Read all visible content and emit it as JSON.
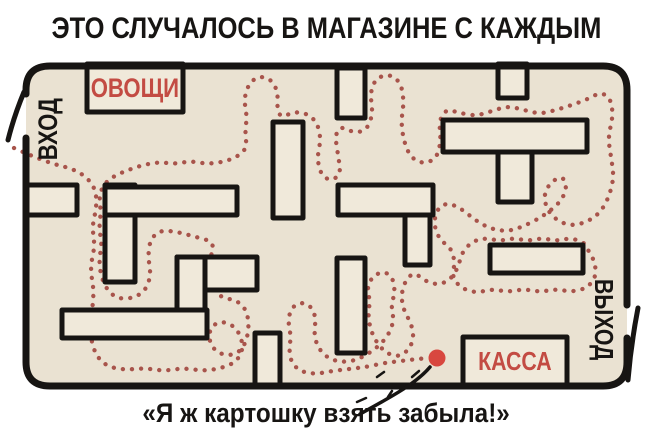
{
  "title": "ЭТО СЛУЧАЛОСЬ В МАГАЗИНЕ С КАЖДЫМ",
  "caption": "«Я ж картошку взять забыла!»",
  "labels": {
    "entrance": "ВХОД",
    "exit": "ВЫХОД",
    "vegetables": "ОВОЩИ",
    "checkout": "КАССА"
  },
  "colors": {
    "background": "#ffffff",
    "floor": "#eae2d2",
    "shelf_fill": "#f0e9da",
    "wall_black": "#171513",
    "path_dots": "#a8544b",
    "label_red": "#c34b43",
    "end_dot_red": "#d8473f"
  },
  "maze": {
    "floor_rect": [
      26,
      66,
      601,
      320
    ],
    "shelves": [
      [
        87,
        64,
        96,
        48
      ],
      [
        27,
        185,
        50,
        30
      ],
      [
        105,
        185,
        30,
        97
      ],
      [
        105,
        187,
        132,
        28
      ],
      [
        273,
        122,
        30,
        96
      ],
      [
        337,
        68,
        28,
        50
      ],
      [
        498,
        64,
        29,
        34
      ],
      [
        443,
        120,
        144,
        32
      ],
      [
        498,
        152,
        34,
        50
      ],
      [
        338,
        185,
        95,
        30
      ],
      [
        405,
        215,
        25,
        50
      ],
      [
        177,
        257,
        80,
        33
      ],
      [
        177,
        257,
        28,
        53
      ],
      [
        62,
        310,
        145,
        28
      ],
      [
        255,
        333,
        25,
        52
      ],
      [
        337,
        258,
        28,
        95
      ],
      [
        490,
        245,
        93,
        28
      ],
      [
        463,
        337,
        104,
        48
      ]
    ],
    "doors": [
      [
        24,
        92,
        8,
        140
      ],
      [
        638,
        308,
        628,
        380
      ]
    ],
    "end_dot": {
      "x": 437,
      "y": 358,
      "r": 8.5
    },
    "annotation": {
      "line": [
        360,
        414,
        385,
        400,
        415,
        385,
        430,
        367
      ],
      "ticks": [
        [
          384,
          372,
          377,
          377
        ],
        [
          366,
          398,
          357,
          402
        ],
        [
          412,
          377,
          419,
          371
        ],
        [
          392,
          391,
          388,
          397
        ]
      ]
    },
    "path": [
      [
        14,
        148
      ],
      [
        45,
        162
      ],
      [
        78,
        170
      ],
      [
        95,
        186
      ],
      [
        97,
        206
      ],
      [
        92,
        226
      ],
      [
        95,
        246
      ],
      [
        90,
        268
      ],
      [
        94,
        290
      ],
      [
        92,
        312
      ],
      [
        90,
        334
      ],
      [
        95,
        354
      ],
      [
        106,
        366
      ],
      [
        124,
        370
      ],
      [
        144,
        368
      ],
      [
        164,
        371
      ],
      [
        184,
        368
      ],
      [
        204,
        371
      ],
      [
        222,
        368
      ],
      [
        236,
        362
      ],
      [
        243,
        350
      ],
      [
        241,
        336
      ],
      [
        233,
        325
      ],
      [
        220,
        321
      ],
      [
        210,
        328
      ],
      [
        209,
        341
      ],
      [
        216,
        352
      ],
      [
        229,
        356
      ],
      [
        241,
        351
      ],
      [
        247,
        339
      ],
      [
        249,
        324
      ],
      [
        246,
        309
      ],
      [
        236,
        300
      ],
      [
        222,
        298
      ],
      [
        212,
        288
      ],
      [
        209,
        272
      ],
      [
        211,
        256
      ],
      [
        214,
        242
      ],
      [
        196,
        237
      ],
      [
        178,
        232
      ],
      [
        160,
        230
      ],
      [
        150,
        240
      ],
      [
        148,
        257
      ],
      [
        151,
        274
      ],
      [
        146,
        290
      ],
      [
        134,
        298
      ],
      [
        118,
        299
      ],
      [
        107,
        290
      ],
      [
        101,
        276
      ],
      [
        99,
        260
      ],
      [
        102,
        244
      ],
      [
        99,
        228
      ],
      [
        101,
        212
      ],
      [
        99,
        196
      ],
      [
        104,
        184
      ],
      [
        114,
        176
      ],
      [
        128,
        170
      ],
      [
        143,
        165
      ],
      [
        159,
        162
      ],
      [
        175,
        164
      ],
      [
        191,
        161
      ],
      [
        207,
        164
      ],
      [
        223,
        162
      ],
      [
        237,
        157
      ],
      [
        247,
        148
      ],
      [
        245,
        133
      ],
      [
        247,
        116
      ],
      [
        244,
        100
      ],
      [
        248,
        85
      ],
      [
        258,
        76
      ],
      [
        271,
        79
      ],
      [
        278,
        92
      ],
      [
        277,
        108
      ],
      [
        281,
        118
      ],
      [
        293,
        112
      ],
      [
        306,
        113
      ],
      [
        317,
        122
      ],
      [
        321,
        139
      ],
      [
        317,
        158
      ],
      [
        321,
        175
      ],
      [
        331,
        181
      ],
      [
        341,
        174
      ],
      [
        338,
        155
      ],
      [
        335,
        135
      ],
      [
        341,
        126
      ],
      [
        354,
        133
      ],
      [
        367,
        130
      ],
      [
        373,
        113
      ],
      [
        370,
        93
      ],
      [
        376,
        78
      ],
      [
        390,
        74
      ],
      [
        401,
        83
      ],
      [
        404,
        102
      ],
      [
        401,
        122
      ],
      [
        404,
        142
      ],
      [
        411,
        158
      ],
      [
        424,
        164
      ],
      [
        437,
        158
      ],
      [
        441,
        140
      ],
      [
        439,
        121
      ],
      [
        446,
        109
      ],
      [
        460,
        113
      ],
      [
        476,
        116
      ],
      [
        492,
        111
      ],
      [
        508,
        106
      ],
      [
        524,
        110
      ],
      [
        540,
        114
      ],
      [
        556,
        110
      ],
      [
        572,
        105
      ],
      [
        588,
        99
      ],
      [
        601,
        92
      ],
      [
        611,
        99
      ],
      [
        613,
        117
      ],
      [
        608,
        137
      ],
      [
        611,
        157
      ],
      [
        614,
        177
      ],
      [
        609,
        197
      ],
      [
        600,
        213
      ],
      [
        587,
        222
      ],
      [
        571,
        226
      ],
      [
        556,
        220
      ],
      [
        546,
        208
      ],
      [
        544,
        193
      ],
      [
        552,
        181
      ],
      [
        563,
        176
      ],
      [
        567,
        188
      ],
      [
        561,
        201
      ],
      [
        550,
        211
      ],
      [
        538,
        219
      ],
      [
        524,
        226
      ],
      [
        510,
        231
      ],
      [
        495,
        230
      ],
      [
        481,
        224
      ],
      [
        469,
        215
      ],
      [
        457,
        206
      ],
      [
        445,
        203
      ],
      [
        436,
        211
      ],
      [
        434,
        226
      ],
      [
        440,
        240
      ],
      [
        451,
        248
      ],
      [
        455,
        262
      ],
      [
        452,
        277
      ],
      [
        461,
        288
      ],
      [
        476,
        293
      ],
      [
        492,
        289
      ],
      [
        508,
        292
      ],
      [
        524,
        289
      ],
      [
        540,
        292
      ],
      [
        556,
        289
      ],
      [
        572,
        292
      ],
      [
        587,
        288
      ],
      [
        596,
        277
      ],
      [
        595,
        262
      ],
      [
        588,
        250
      ],
      [
        584,
        242
      ],
      [
        570,
        238
      ],
      [
        556,
        241
      ],
      [
        542,
        238
      ],
      [
        528,
        241
      ],
      [
        514,
        238
      ],
      [
        500,
        241
      ],
      [
        486,
        238
      ],
      [
        473,
        241
      ],
      [
        462,
        252
      ],
      [
        458,
        268
      ],
      [
        450,
        280
      ],
      [
        438,
        285
      ],
      [
        425,
        281
      ],
      [
        414,
        272
      ],
      [
        405,
        281
      ],
      [
        401,
        296
      ],
      [
        404,
        311
      ],
      [
        411,
        323
      ],
      [
        414,
        337
      ],
      [
        409,
        350
      ],
      [
        398,
        357
      ],
      [
        386,
        353
      ],
      [
        377,
        343
      ],
      [
        371,
        331
      ],
      [
        368,
        316
      ],
      [
        370,
        301
      ],
      [
        367,
        287
      ],
      [
        373,
        276
      ],
      [
        384,
        271
      ],
      [
        393,
        278
      ],
      [
        395,
        292
      ],
      [
        391,
        306
      ],
      [
        394,
        320
      ],
      [
        389,
        334
      ],
      [
        380,
        345
      ],
      [
        368,
        354
      ],
      [
        354,
        361
      ],
      [
        339,
        362
      ],
      [
        326,
        357
      ],
      [
        317,
        346
      ],
      [
        314,
        332
      ],
      [
        316,
        318
      ],
      [
        311,
        306
      ],
      [
        301,
        302
      ],
      [
        291,
        308
      ],
      [
        288,
        322
      ],
      [
        291,
        336
      ],
      [
        289,
        351
      ],
      [
        292,
        364
      ],
      [
        302,
        372
      ],
      [
        316,
        374
      ],
      [
        332,
        371
      ],
      [
        349,
        369
      ],
      [
        366,
        367
      ],
      [
        384,
        363
      ],
      [
        401,
        361
      ],
      [
        417,
        359
      ],
      [
        430,
        358
      ]
    ]
  }
}
